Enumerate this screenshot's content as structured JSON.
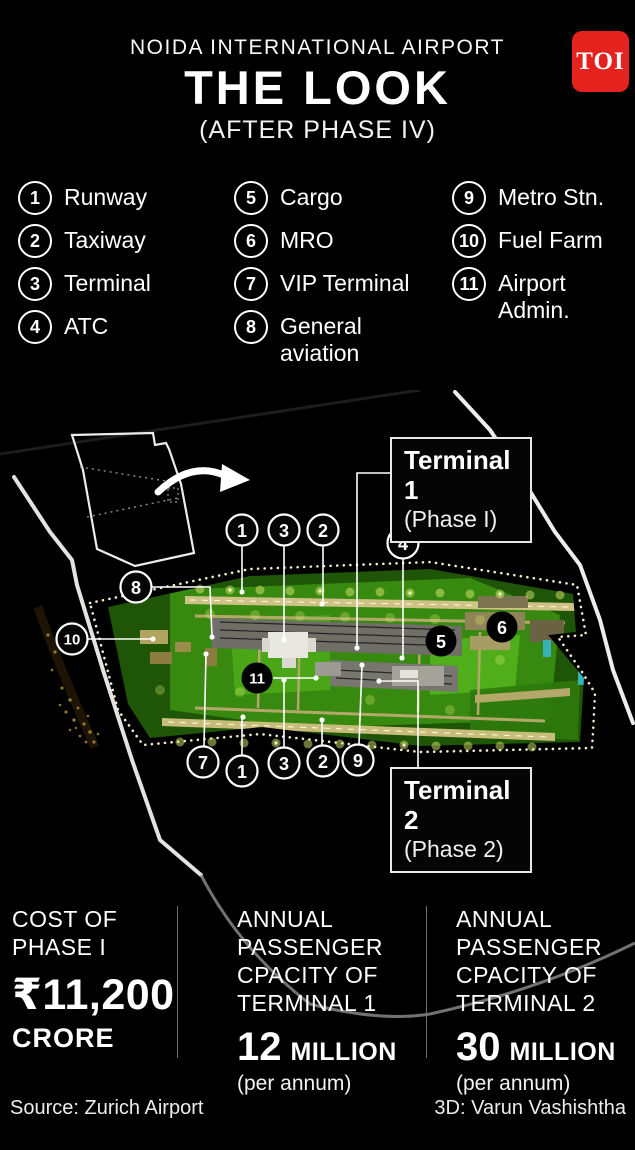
{
  "brand": {
    "name": "TOI",
    "color": "#e5231e"
  },
  "header": {
    "kicker": "NOIDA INTERNATIONAL AIRPORT",
    "title": "THE LOOK",
    "subtitle": "(AFTER PHASE IV)"
  },
  "legend": {
    "columns": [
      {
        "items": [
          {
            "num": "1",
            "label": "Runway"
          },
          {
            "num": "2",
            "label": "Taxiway"
          },
          {
            "num": "3",
            "label": "Terminal"
          },
          {
            "num": "4",
            "label": "ATC"
          }
        ]
      },
      {
        "items": [
          {
            "num": "5",
            "label": "Cargo"
          },
          {
            "num": "6",
            "label": "MRO"
          },
          {
            "num": "7",
            "label": "VIP Terminal"
          },
          {
            "num": "8",
            "label": "General aviation"
          }
        ]
      },
      {
        "items": [
          {
            "num": "9",
            "label": "Metro Stn."
          },
          {
            "num": "10",
            "label": "Fuel Farm"
          },
          {
            "num": "11",
            "label": "Airport Admin."
          }
        ]
      }
    ]
  },
  "map": {
    "terminal1": {
      "title": "Terminal 1",
      "phase": "(Phase I)"
    },
    "terminal2": {
      "title": "Terminal 2",
      "phase": "(Phase 2)"
    },
    "callouts": {
      "t1": "1",
      "t3": "3",
      "t2": "2",
      "c4": "4",
      "c8": "8",
      "c10": "10",
      "c11": "11",
      "c5": "5",
      "c6": "6",
      "c7": "7",
      "b1": "1",
      "b3": "3",
      "b2": "2",
      "c9": "9"
    }
  },
  "stats": [
    {
      "heading": [
        "COST OF",
        "PHASE I"
      ],
      "value": "₹11,200",
      "unit": "CRORE"
    },
    {
      "heading": [
        "ANNUAL",
        "PASSENGER",
        "CPACITY OF",
        "TERMINAL 1"
      ],
      "value": "12",
      "unit": "MILLION",
      "note": "(per annum)"
    },
    {
      "heading": [
        "ANNUAL",
        "PASSENGER",
        "CPACITY OF",
        "TERMINAL 2"
      ],
      "value": "30",
      "unit": "MILLION",
      "note": "(per annum)"
    }
  ],
  "footer": {
    "source": "Source: Zurich Airport",
    "credit": "3D: Varun Vashishtha"
  },
  "colors": {
    "toi_red": "#e5231e",
    "map_green": "#3f9e14",
    "runway_tan": "#cfc286",
    "glow_yellow": "#d8e76e",
    "boundary_dots": "#f2ecca"
  }
}
